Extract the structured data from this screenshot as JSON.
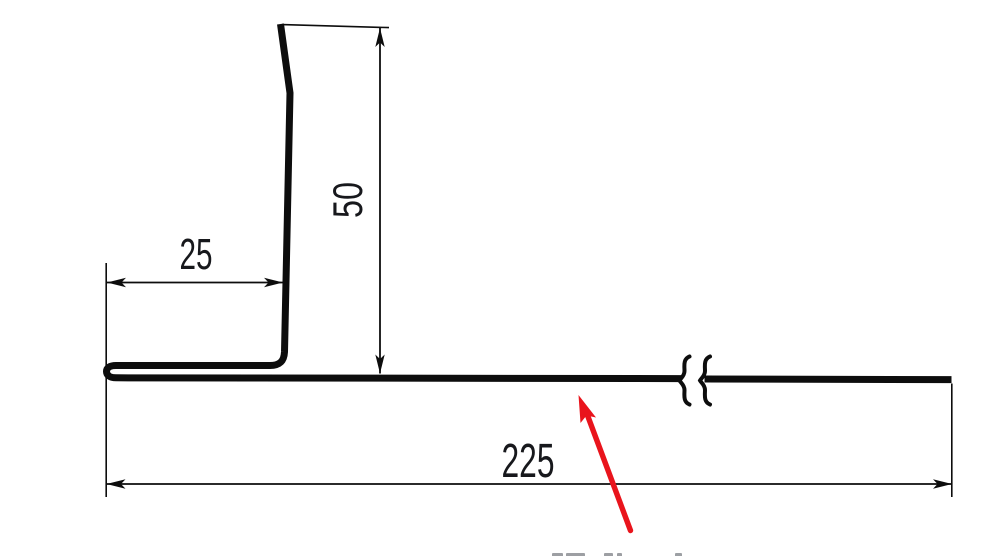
{
  "drawing": {
    "kind": "flashing-profile-cross-section",
    "background": "#ffffff",
    "line_color": "#0d0d0d",
    "text_color": "#17181c",
    "pointer_color": "#e9141c",
    "caption_fragment_color": "#8c8f94",
    "dimensions": {
      "hem_width": {
        "label": "25"
      },
      "upstand_height": {
        "label": "50"
      },
      "base_length": {
        "label": "225"
      }
    }
  }
}
